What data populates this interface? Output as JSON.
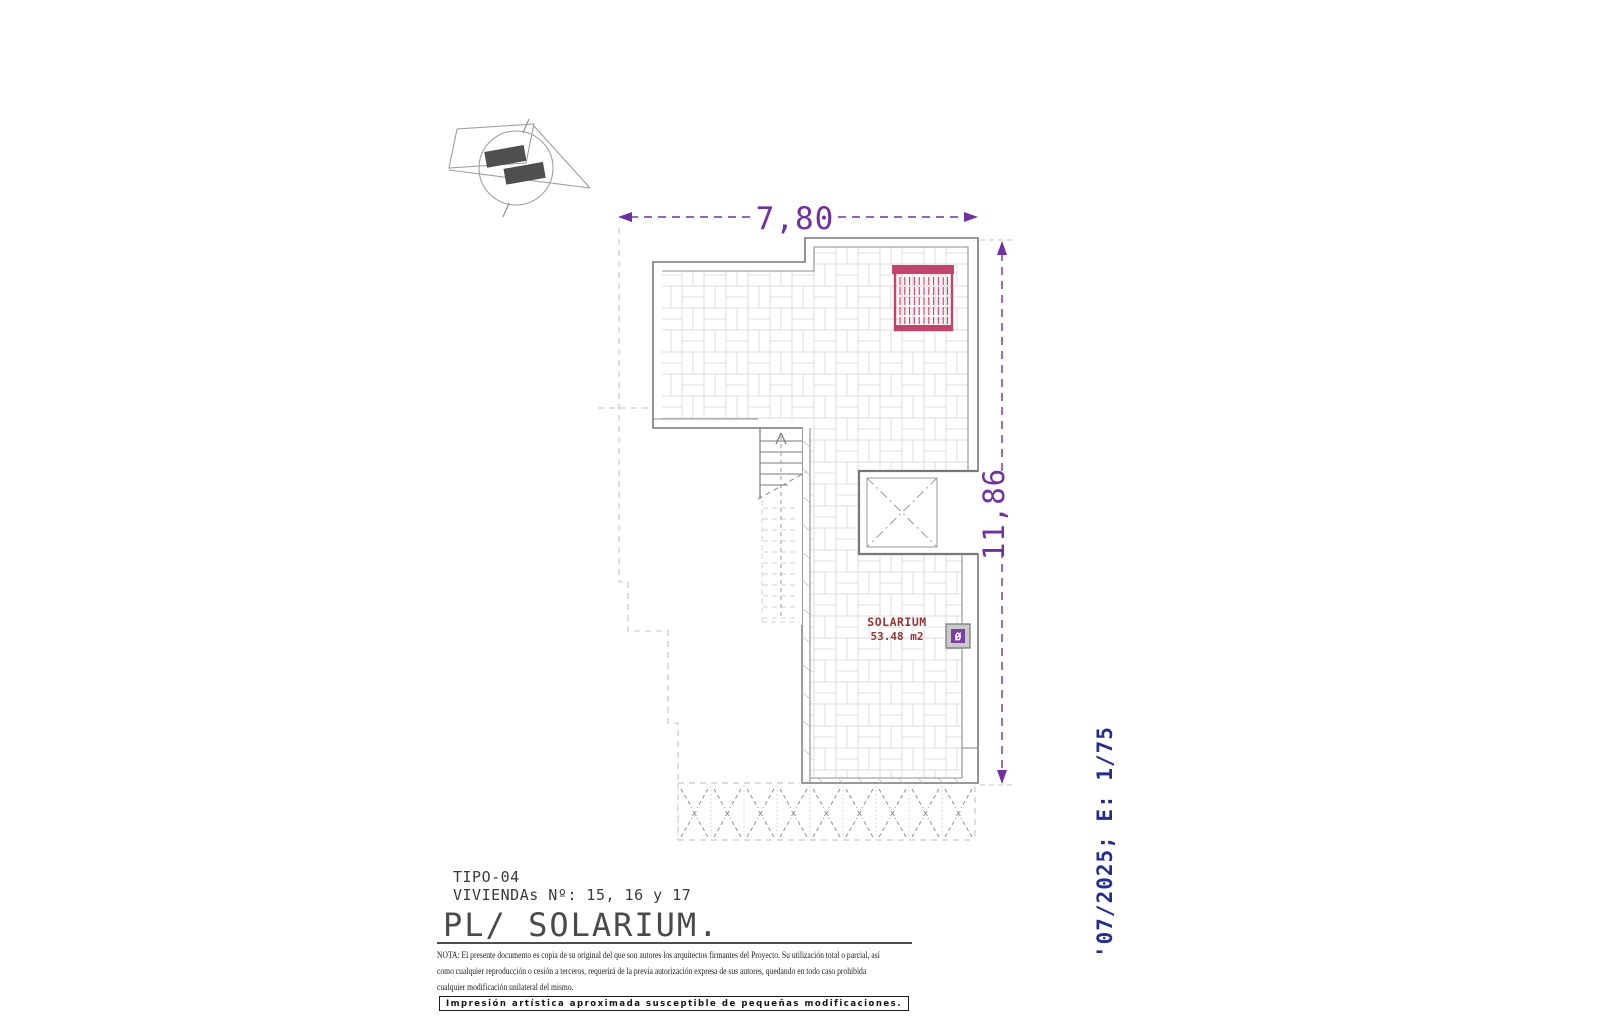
{
  "title_block": {
    "type_label": "TIPO-04",
    "dwellings_label": "VIVIENDAs Nº: 15, 16 y 17",
    "plan_label": "PL/ SOLARIUM."
  },
  "note": {
    "line1": "NOTA: El presente documento es copia de su original del que son autores los arquitectos firmantes del Proyecto. Su utilización total o parcial, así",
    "line2": "como cualquier reproducción o cesión a terceros, requerirá  de la previa autorización expresa de sus autores, quedando en todo caso prohibida",
    "line3": "cualquier modificación unilateral del mismo."
  },
  "print_bar": {
    "words": [
      "Impresión",
      "artística",
      "aproximada",
      "susceptible",
      "de",
      "pequeñas",
      "modificaciones."
    ]
  },
  "revision": {
    "date_scale": "'07/2025; E: 1/75"
  },
  "dimensions": {
    "width_label": "7,80",
    "height_label": "11,86"
  },
  "room": {
    "name": "SOLARIUM",
    "area": "53.48 m2"
  },
  "symbols": {
    "drain": "Ø",
    "louver_mark": "x"
  },
  "colors": {
    "dimension_purple": "#7030a0",
    "pergola_red": "#c2446d",
    "room_label_maroon": "#943434",
    "revision_navy": "#252e8c",
    "outline_gray": "#777777"
  }
}
